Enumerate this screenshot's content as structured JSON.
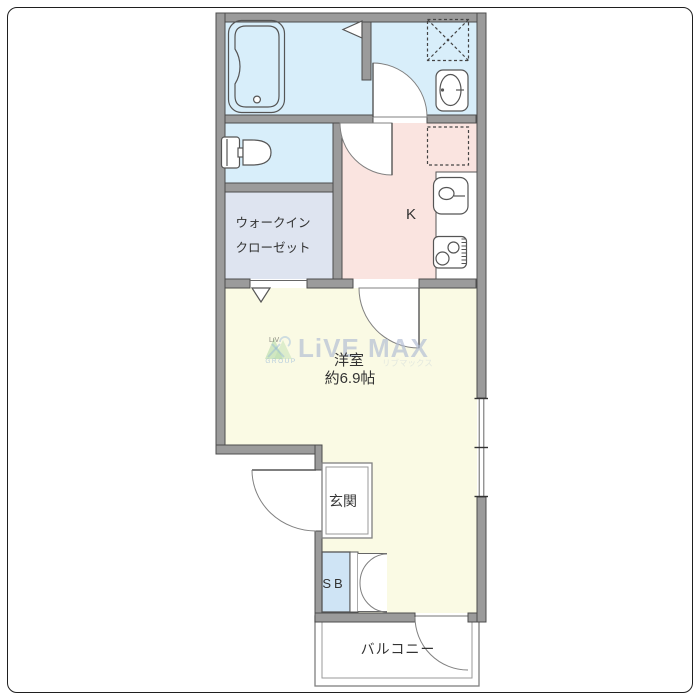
{
  "title": "apartment-floor-plan",
  "labels": {
    "kitchen": "K",
    "wic1": "ウォークイン",
    "wic2": "クローゼット",
    "room_name": "洋室",
    "room_size": "約6.9帖",
    "genkan": "玄関",
    "shoebox": "SB",
    "balcony": "バルコニー"
  },
  "watermark": {
    "brand": "LiVE MAX",
    "logo_top": "LiV",
    "logo_group": "GROUP",
    "katakana": "リブマックス"
  },
  "icons": {
    "bathtub-icon": "rounded-tub-outline",
    "washing-machine-pan-icon": "dashed-square-with-x",
    "wash-basin-icon": "oval-basin-in-rounded-rect",
    "toilet-icon": "tank-and-bowl",
    "refrigerator-space-icon": "dashed-square",
    "kitchen-sink-icon": "rounded-rect-oval-faucet",
    "stove-icon": "two-burner-rounded-rect",
    "folding-door-marker-icon": "triangle",
    "door-swing-icon": "quarter-circle-arc",
    "window-icon": "double-line-with-ticks"
  },
  "colors": {
    "wall": "#9b9b9b",
    "wallOutline": "#4c4c4c",
    "bath": "#d8eefa",
    "wic": "#dee4f0",
    "kitchen": "#fae4e0",
    "room": "#fafae4",
    "shoebox": "#cfe4f5",
    "text": "#333333",
    "watermarkBlue": "#b3bed4",
    "watermarkGreen": "#8fca8c"
  }
}
